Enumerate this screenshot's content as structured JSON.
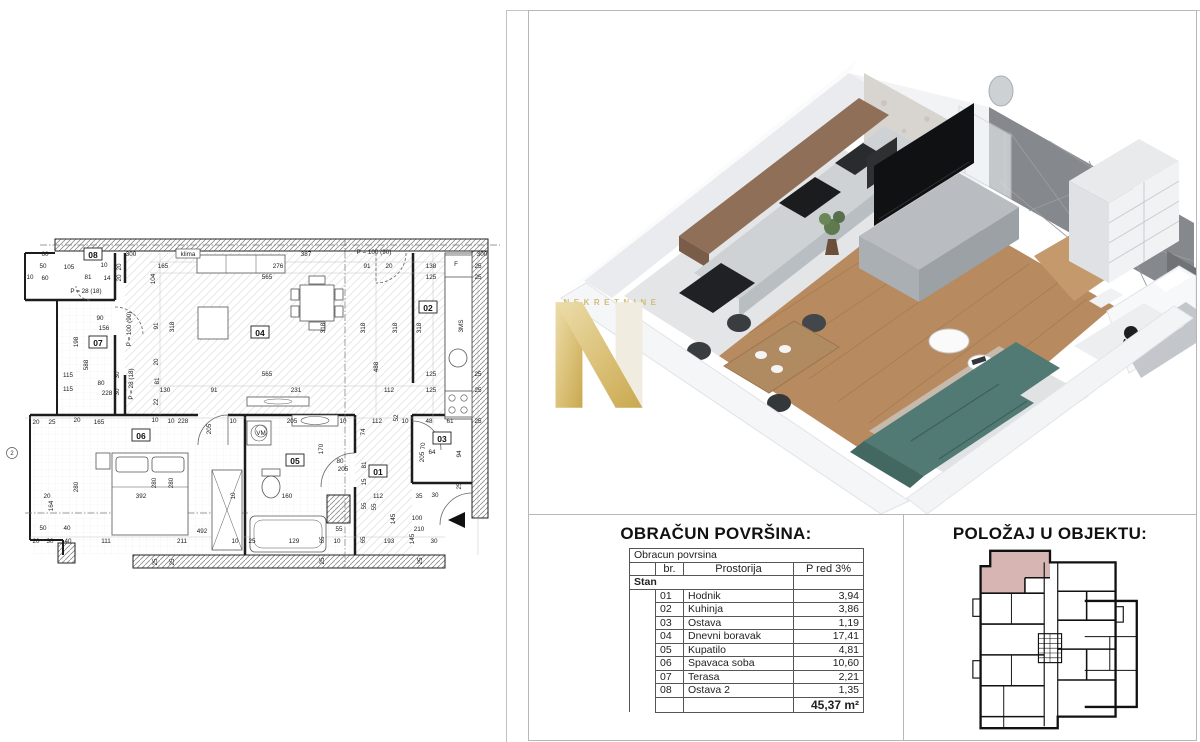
{
  "watermark": {
    "letter": "N",
    "text": "NEKRETNINE"
  },
  "colors": {
    "gold": "#dcc37c",
    "gold_dark": "#c9a84f",
    "highlight": "#d0a8a4",
    "wood": "#b78a5f",
    "sofa": "#517a74",
    "accent_wall": "#85888c",
    "cabinet_brown": "#8f6f57"
  },
  "area_table": {
    "title": "OBRAČUN POVRŠINA:",
    "subtitle": "Obracun povrsina",
    "col_br": "br.",
    "col_room": "Prostorija",
    "col_area": "P red 3%",
    "group": "Stan",
    "rows": [
      {
        "br": "01",
        "room": "Hodnik",
        "area": "3,94"
      },
      {
        "br": "02",
        "room": "Kuhinja",
        "area": "3,86"
      },
      {
        "br": "03",
        "room": "Ostava",
        "area": "1,19"
      },
      {
        "br": "04",
        "room": "Dnevni boravak",
        "area": "17,41"
      },
      {
        "br": "05",
        "room": "Kupatilo",
        "area": "4,81"
      },
      {
        "br": "06",
        "room": "Spavaca soba",
        "area": "10,60"
      },
      {
        "br": "07",
        "room": "Terasa",
        "area": "2,21"
      },
      {
        "br": "08",
        "room": "Ostava 2",
        "area": "1,35"
      }
    ],
    "total": "45,37 m²"
  },
  "position": {
    "title": "POLOŽAJ U OBJEKTU:"
  },
  "floor_plan": {
    "rooms": [
      {
        "id": "08",
        "x": 93,
        "y": 30
      },
      {
        "id": "07",
        "x": 98,
        "y": 118
      },
      {
        "id": "04",
        "x": 260,
        "y": 108
      },
      {
        "id": "02",
        "x": 428,
        "y": 83
      },
      {
        "id": "03",
        "x": 442,
        "y": 214
      },
      {
        "id": "01",
        "x": 378,
        "y": 247
      },
      {
        "id": "05",
        "x": 295,
        "y": 236
      },
      {
        "id": "06",
        "x": 141,
        "y": 211
      }
    ],
    "axis_marker": "2",
    "dims": [
      {
        "t": "60",
        "x": 45,
        "y": 29
      },
      {
        "t": "50",
        "x": 43,
        "y": 41
      },
      {
        "t": "60",
        "x": 45,
        "y": 53
      },
      {
        "t": "10",
        "x": 30,
        "y": 52
      },
      {
        "t": "105",
        "x": 69,
        "y": 42
      },
      {
        "t": "10",
        "x": 104,
        "y": 40
      },
      {
        "t": "81",
        "x": 88,
        "y": 52
      },
      {
        "t": "14",
        "x": 107,
        "y": 53
      },
      {
        "t": "20",
        "x": 119,
        "y": 42,
        "r": 1
      },
      {
        "t": "20",
        "x": 119,
        "y": 53,
        "r": 1
      },
      {
        "t": "300",
        "x": 131,
        "y": 29
      },
      {
        "t": "klima",
        "x": 188,
        "y": 29,
        "b": 1
      },
      {
        "t": "387",
        "x": 306,
        "y": 29
      },
      {
        "t": "P = 100 (90)",
        "x": 374,
        "y": 27
      },
      {
        "t": "165",
        "x": 163,
        "y": 41
      },
      {
        "t": "104",
        "x": 153,
        "y": 54,
        "r": 1
      },
      {
        "t": "276",
        "x": 278,
        "y": 41
      },
      {
        "t": "565",
        "x": 267,
        "y": 52
      },
      {
        "t": "91",
        "x": 367,
        "y": 41
      },
      {
        "t": "20",
        "x": 389,
        "y": 41
      },
      {
        "t": "138",
        "x": 431,
        "y": 41
      },
      {
        "t": "F",
        "x": 456,
        "y": 39
      },
      {
        "t": "25",
        "x": 478,
        "y": 41
      },
      {
        "t": "125",
        "x": 431,
        "y": 52
      },
      {
        "t": "25",
        "x": 478,
        "y": 52
      },
      {
        "t": "P = 28 (18)",
        "x": 86,
        "y": 66
      },
      {
        "t": "90",
        "x": 100,
        "y": 93
      },
      {
        "t": "156",
        "x": 104,
        "y": 103
      },
      {
        "t": "198",
        "x": 76,
        "y": 117,
        "r": 1
      },
      {
        "t": "588",
        "x": 86,
        "y": 140,
        "r": 1
      },
      {
        "t": "115",
        "x": 68,
        "y": 150
      },
      {
        "t": "115",
        "x": 68,
        "y": 164
      },
      {
        "t": "80",
        "x": 101,
        "y": 158
      },
      {
        "t": "228",
        "x": 107,
        "y": 168
      },
      {
        "t": "30",
        "x": 117,
        "y": 150,
        "r": 1
      },
      {
        "t": "30",
        "x": 117,
        "y": 167,
        "r": 1
      },
      {
        "t": "P = 100 (90)",
        "x": 129,
        "y": 104,
        "r": 1
      },
      {
        "t": "P = 28 (18)",
        "x": 131,
        "y": 159,
        "r": 1
      },
      {
        "t": "91",
        "x": 156,
        "y": 101,
        "r": 1
      },
      {
        "t": "318",
        "x": 172,
        "y": 102,
        "r": 1
      },
      {
        "t": "20",
        "x": 156,
        "y": 137,
        "r": 1
      },
      {
        "t": "81",
        "x": 157,
        "y": 156,
        "r": 1
      },
      {
        "t": "130",
        "x": 165,
        "y": 165
      },
      {
        "t": "22",
        "x": 156,
        "y": 177,
        "r": 1
      },
      {
        "t": "91",
        "x": 214,
        "y": 165
      },
      {
        "t": "318",
        "x": 323,
        "y": 103,
        "r": 1
      },
      {
        "t": "318",
        "x": 363,
        "y": 103,
        "r": 1
      },
      {
        "t": "318",
        "x": 395,
        "y": 103,
        "r": 1
      },
      {
        "t": "318",
        "x": 419,
        "y": 103,
        "r": 1
      },
      {
        "t": "565",
        "x": 267,
        "y": 149
      },
      {
        "t": "488",
        "x": 376,
        "y": 142,
        "r": 1
      },
      {
        "t": "231",
        "x": 296,
        "y": 165
      },
      {
        "t": "112",
        "x": 389,
        "y": 165
      },
      {
        "t": "125",
        "x": 431,
        "y": 149
      },
      {
        "t": "125",
        "x": 431,
        "y": 165
      },
      {
        "t": "25",
        "x": 478,
        "y": 149
      },
      {
        "t": "25",
        "x": 478,
        "y": 165
      },
      {
        "t": "3MS",
        "x": 461,
        "y": 101,
        "r": 1
      },
      {
        "t": "300",
        "x": 482,
        "y": 29
      },
      {
        "t": "228",
        "x": 183,
        "y": 196
      },
      {
        "t": "10",
        "x": 233,
        "y": 196
      },
      {
        "t": "205",
        "x": 292,
        "y": 196
      },
      {
        "t": "10",
        "x": 343,
        "y": 196
      },
      {
        "t": "112",
        "x": 377,
        "y": 196
      },
      {
        "t": "52",
        "x": 396,
        "y": 193,
        "r": 1
      },
      {
        "t": "10",
        "x": 405,
        "y": 196
      },
      {
        "t": "48",
        "x": 429,
        "y": 196
      },
      {
        "t": "61",
        "x": 450,
        "y": 196
      },
      {
        "t": "25",
        "x": 478,
        "y": 196
      },
      {
        "t": "165",
        "x": 99,
        "y": 197
      },
      {
        "t": "25",
        "x": 52,
        "y": 197
      },
      {
        "t": "20",
        "x": 36,
        "y": 197
      },
      {
        "t": "20",
        "x": 77,
        "y": 195
      },
      {
        "t": "10",
        "x": 155,
        "y": 195
      },
      {
        "t": "10",
        "x": 171,
        "y": 196
      },
      {
        "t": "205",
        "x": 209,
        "y": 204,
        "r": 1
      },
      {
        "t": "VM",
        "x": 261,
        "y": 208,
        "c": 1
      },
      {
        "t": "280",
        "x": 76,
        "y": 262,
        "r": 1
      },
      {
        "t": "164",
        "x": 51,
        "y": 281,
        "r": 1
      },
      {
        "t": "20",
        "x": 47,
        "y": 271
      },
      {
        "t": "392",
        "x": 141,
        "y": 271
      },
      {
        "t": "280",
        "x": 154,
        "y": 258,
        "r": 1
      },
      {
        "t": "280",
        "x": 171,
        "y": 258,
        "r": 1
      },
      {
        "t": "10",
        "x": 233,
        "y": 271,
        "r": 1
      },
      {
        "t": "50",
        "x": 43,
        "y": 303
      },
      {
        "t": "40",
        "x": 67,
        "y": 303
      },
      {
        "t": "492",
        "x": 202,
        "y": 306
      },
      {
        "t": "20",
        "x": 36,
        "y": 316
      },
      {
        "t": "30",
        "x": 50,
        "y": 316
      },
      {
        "t": "40",
        "x": 68,
        "y": 316
      },
      {
        "t": "111",
        "x": 106,
        "y": 316
      },
      {
        "t": "211",
        "x": 182,
        "y": 316
      },
      {
        "t": "10",
        "x": 235,
        "y": 316
      },
      {
        "t": "25",
        "x": 252,
        "y": 316
      },
      {
        "t": "129",
        "x": 294,
        "y": 316
      },
      {
        "t": "65",
        "x": 322,
        "y": 315,
        "r": 1
      },
      {
        "t": "10",
        "x": 337,
        "y": 316
      },
      {
        "t": "65",
        "x": 363,
        "y": 315,
        "r": 1
      },
      {
        "t": "193",
        "x": 389,
        "y": 316
      },
      {
        "t": "145",
        "x": 412,
        "y": 314,
        "r": 1
      },
      {
        "t": "30",
        "x": 434,
        "y": 316
      },
      {
        "t": "170",
        "x": 321,
        "y": 224,
        "r": 1
      },
      {
        "t": "80",
        "x": 340,
        "y": 236
      },
      {
        "t": "205",
        "x": 343,
        "y": 244
      },
      {
        "t": "74",
        "x": 363,
        "y": 207,
        "r": 1
      },
      {
        "t": "81",
        "x": 364,
        "y": 240,
        "r": 1
      },
      {
        "t": "15",
        "x": 364,
        "y": 257,
        "r": 1
      },
      {
        "t": "112",
        "x": 378,
        "y": 271
      },
      {
        "t": "55",
        "x": 364,
        "y": 281,
        "r": 1
      },
      {
        "t": "55",
        "x": 374,
        "y": 282,
        "r": 1
      },
      {
        "t": "160",
        "x": 287,
        "y": 271
      },
      {
        "t": "55",
        "x": 339,
        "y": 304
      },
      {
        "t": "70",
        "x": 423,
        "y": 221,
        "r": 1
      },
      {
        "t": "205",
        "x": 422,
        "y": 232,
        "r": 1
      },
      {
        "t": "64",
        "x": 432,
        "y": 227
      },
      {
        "t": "94",
        "x": 459,
        "y": 229,
        "r": 1
      },
      {
        "t": "25",
        "x": 459,
        "y": 261,
        "r": 1
      },
      {
        "t": "35",
        "x": 419,
        "y": 271
      },
      {
        "t": "30",
        "x": 435,
        "y": 270
      },
      {
        "t": "145",
        "x": 393,
        "y": 294,
        "r": 1
      },
      {
        "t": "100",
        "x": 417,
        "y": 293
      },
      {
        "t": "210",
        "x": 419,
        "y": 304
      },
      {
        "t": "25",
        "x": 155,
        "y": 337,
        "r": 1
      },
      {
        "t": "25",
        "x": 172,
        "y": 337,
        "r": 1
      },
      {
        "t": "25",
        "x": 322,
        "y": 336,
        "r": 1
      },
      {
        "t": "25",
        "x": 420,
        "y": 336,
        "r": 1
      }
    ]
  }
}
